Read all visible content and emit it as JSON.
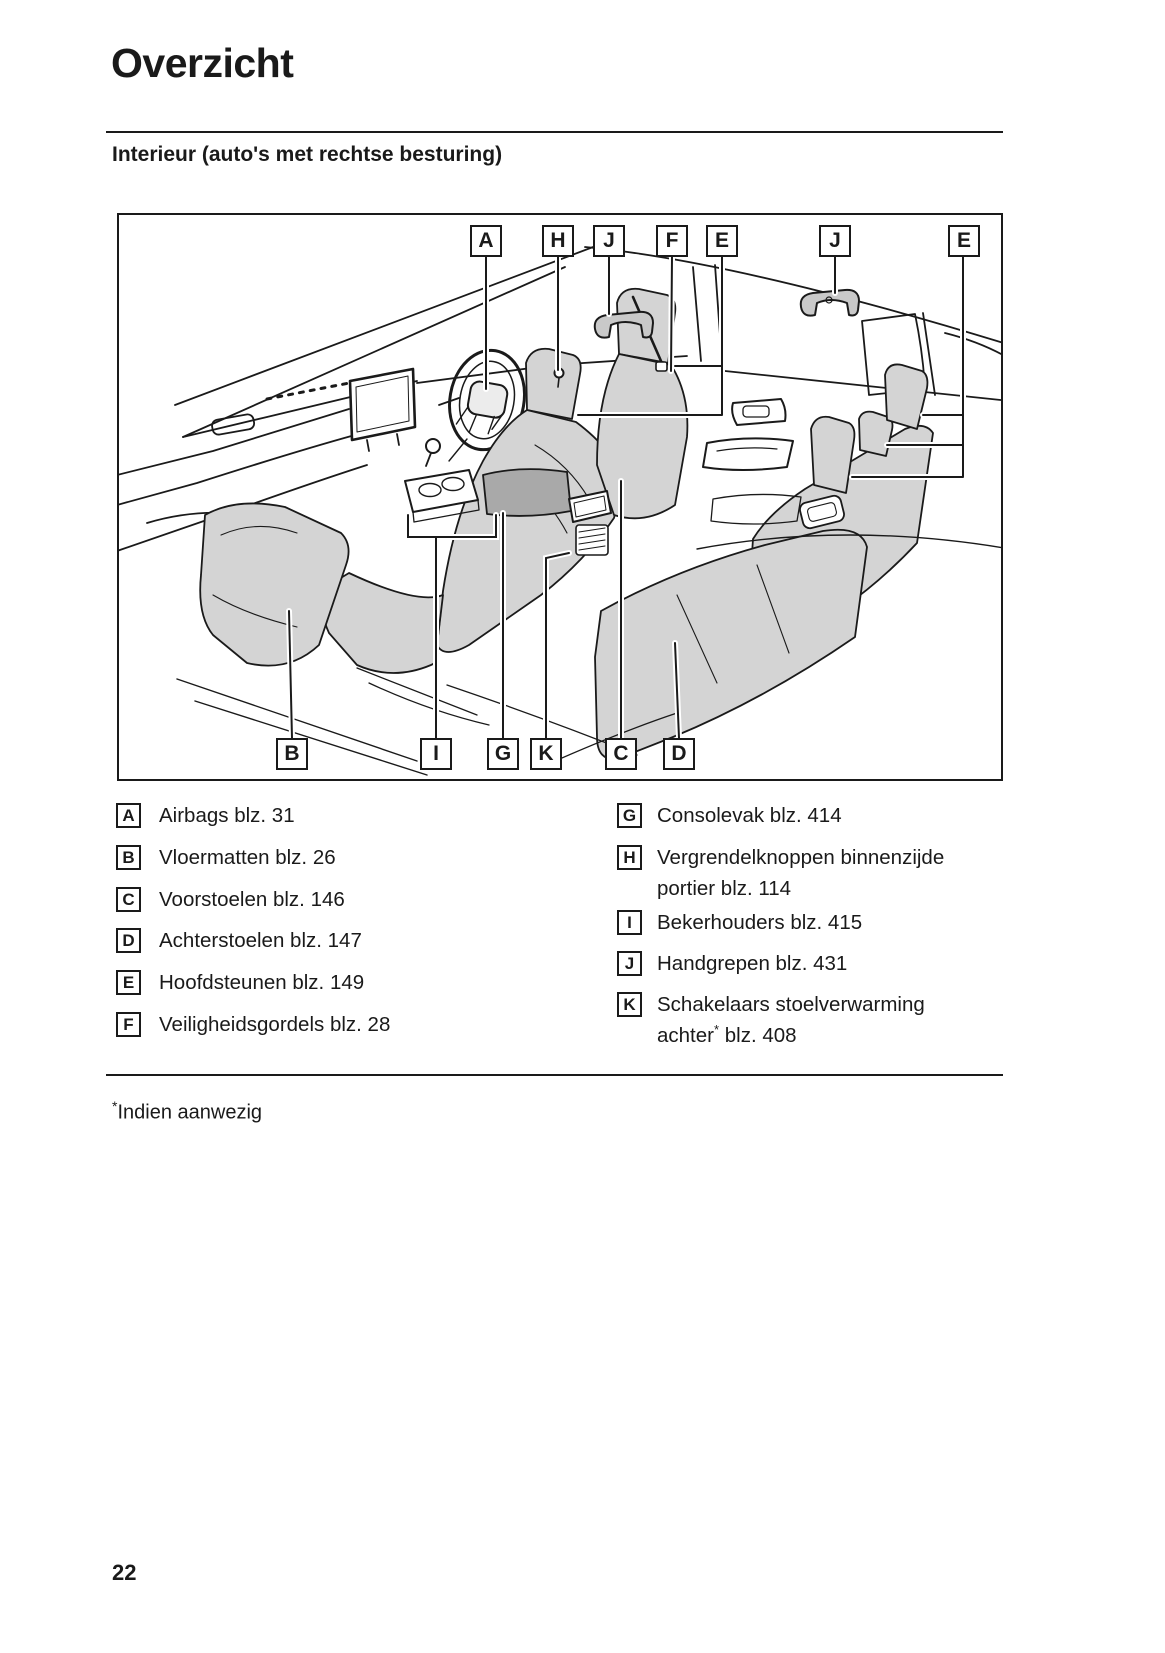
{
  "page": {
    "title": "Overzicht",
    "subtitle": "Interieur (auto's met rechtse besturing)",
    "page_number": "22"
  },
  "diagram": {
    "description": "car-interior-line-drawing-right-hand-drive",
    "top_callouts": [
      {
        "label": "A"
      },
      {
        "label": "H"
      },
      {
        "label": "J"
      },
      {
        "label": "F"
      },
      {
        "label": "E"
      },
      {
        "label": "J"
      },
      {
        "label": "E"
      }
    ],
    "bottom_callouts": [
      {
        "label": "B"
      },
      {
        "label": "I"
      },
      {
        "label": "G"
      },
      {
        "label": "K"
      },
      {
        "label": "C"
      },
      {
        "label": "D"
      }
    ]
  },
  "legend": {
    "left": [
      {
        "key": "A",
        "text": "Airbags blz. 31"
      },
      {
        "key": "B",
        "text": "Vloermatten blz. 26"
      },
      {
        "key": "C",
        "text": "Voorstoelen blz. 146"
      },
      {
        "key": "D",
        "text": "Achterstoelen blz. 147"
      },
      {
        "key": "E",
        "text": "Hoofdsteunen blz. 149"
      },
      {
        "key": "F",
        "text": "Veiligheidsgordels blz. 28"
      }
    ],
    "right": [
      {
        "key": "G",
        "text": "Consolevak blz. 414"
      },
      {
        "key": "H",
        "text": "Vergrendelknoppen binnenzijde portier blz. 114"
      },
      {
        "key": "I",
        "text": "Bekerhouders blz. 415"
      },
      {
        "key": "J",
        "text": "Handgrepen blz. 431"
      },
      {
        "key": "K",
        "text": "Schakelaars stoelverwarming achter",
        "sup": "*",
        "post": " blz. 408"
      }
    ]
  },
  "footnote": {
    "marker": "*",
    "text": "Indien aanwezig"
  },
  "colors": {
    "ink": "#1a1a1a",
    "seat_gray": "#d4d4d4",
    "console_gray": "#a9a9a9",
    "handle_gray": "#c9c9c9"
  }
}
